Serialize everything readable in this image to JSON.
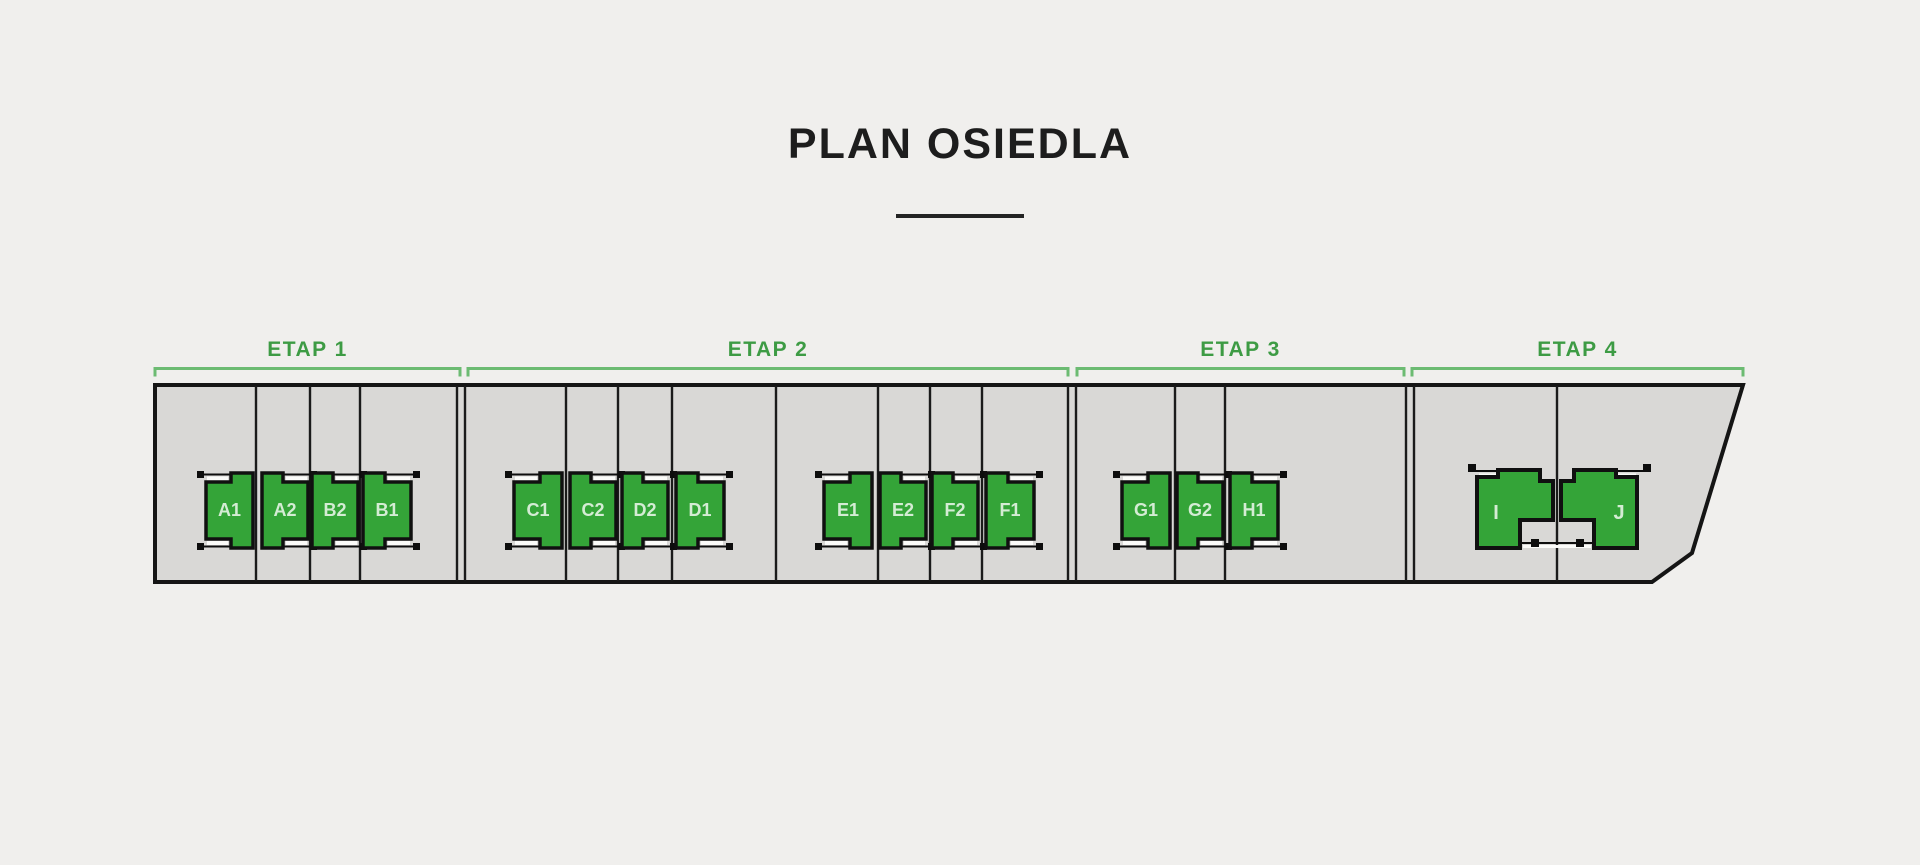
{
  "title": "PLAN OSIEDLA",
  "colors": {
    "background": "#f0efed",
    "parcel_fill": "#d9d8d6",
    "parcel_border": "#151515",
    "divider": "#1a1a1a",
    "building_fill": "#34a438",
    "building_border": "#101010",
    "building_label": "#d4ecd4",
    "etap_label": "#3d9b44",
    "bracket": "#6cbb72",
    "strip": "#fbfbf9",
    "marker": "#0d0d0d"
  },
  "etaps": [
    {
      "label": "ETAP 1",
      "from": 155,
      "to": 460
    },
    {
      "label": "ETAP 2",
      "from": 468,
      "to": 1068
    },
    {
      "label": "ETAP 3",
      "from": 1077,
      "to": 1404
    },
    {
      "label": "ETAP 4",
      "from": 1412,
      "to": 1743
    }
  ],
  "parcel": {
    "outline": [
      [
        155,
        385
      ],
      [
        1743,
        385
      ],
      [
        1692,
        553
      ],
      [
        1652,
        582
      ],
      [
        155,
        582
      ]
    ]
  },
  "dividers": {
    "y1": 386,
    "y2": 581,
    "x_positions": [
      256,
      310,
      360,
      457,
      465,
      566,
      618,
      672,
      776,
      878,
      930,
      982,
      1068,
      1076,
      1175,
      1225,
      1406,
      1414,
      1557
    ]
  },
  "row_units": {
    "top": 473,
    "bottom": 548,
    "inset": 9,
    "tall_frac": 0.46,
    "items": [
      {
        "label": "A1",
        "x": 206,
        "w": 47,
        "side": "R"
      },
      {
        "label": "A2",
        "x": 262,
        "w": 46,
        "side": "L"
      },
      {
        "label": "B2",
        "x": 312,
        "w": 46,
        "side": "L"
      },
      {
        "label": "B1",
        "x": 363,
        "w": 48,
        "side": "L"
      },
      {
        "label": "C1",
        "x": 514,
        "w": 48,
        "side": "R"
      },
      {
        "label": "C2",
        "x": 570,
        "w": 46,
        "side": "L"
      },
      {
        "label": "D2",
        "x": 622,
        "w": 46,
        "side": "L"
      },
      {
        "label": "D1",
        "x": 676,
        "w": 48,
        "side": "L"
      },
      {
        "label": "E1",
        "x": 824,
        "w": 48,
        "side": "R"
      },
      {
        "label": "E2",
        "x": 880,
        "w": 46,
        "side": "L"
      },
      {
        "label": "F2",
        "x": 932,
        "w": 46,
        "side": "L"
      },
      {
        "label": "F1",
        "x": 986,
        "w": 48,
        "side": "L"
      },
      {
        "label": "G1",
        "x": 1122,
        "w": 48,
        "side": "R"
      },
      {
        "label": "G2",
        "x": 1177,
        "w": 46,
        "side": "L"
      },
      {
        "label": "H1",
        "x": 1230,
        "w": 48,
        "side": "L"
      }
    ]
  },
  "duplex_units": {
    "items": [
      {
        "label": "I",
        "polygon": [
          [
            1477,
            477
          ],
          [
            1498,
            477
          ],
          [
            1498,
            470
          ],
          [
            1540,
            470
          ],
          [
            1540,
            481
          ],
          [
            1553,
            481
          ],
          [
            1553,
            520
          ],
          [
            1520,
            520
          ],
          [
            1520,
            548
          ],
          [
            1477,
            548
          ]
        ],
        "label_x": 1496,
        "label_y": 519
      },
      {
        "label": "J",
        "polygon": [
          [
            1637,
            477
          ],
          [
            1616,
            477
          ],
          [
            1616,
            470
          ],
          [
            1574,
            470
          ],
          [
            1574,
            481
          ],
          [
            1561,
            481
          ],
          [
            1561,
            520
          ],
          [
            1594,
            520
          ],
          [
            1594,
            548
          ],
          [
            1637,
            548
          ]
        ],
        "label_x": 1619,
        "label_y": 519
      }
    ],
    "markers": [
      [
        1468,
        464
      ],
      [
        1643,
        464
      ],
      [
        1531,
        539
      ],
      [
        1576,
        539
      ]
    ],
    "lines": [
      [
        1471,
        471,
        1500,
        471
      ],
      [
        1614,
        471,
        1643,
        471
      ],
      [
        1520,
        543,
        1594,
        543
      ]
    ],
    "strips": [
      [
        1479,
        473.5,
        18,
        4
      ],
      [
        1618,
        473.5,
        18,
        4
      ],
      [
        1523,
        545,
        68,
        3
      ]
    ]
  }
}
